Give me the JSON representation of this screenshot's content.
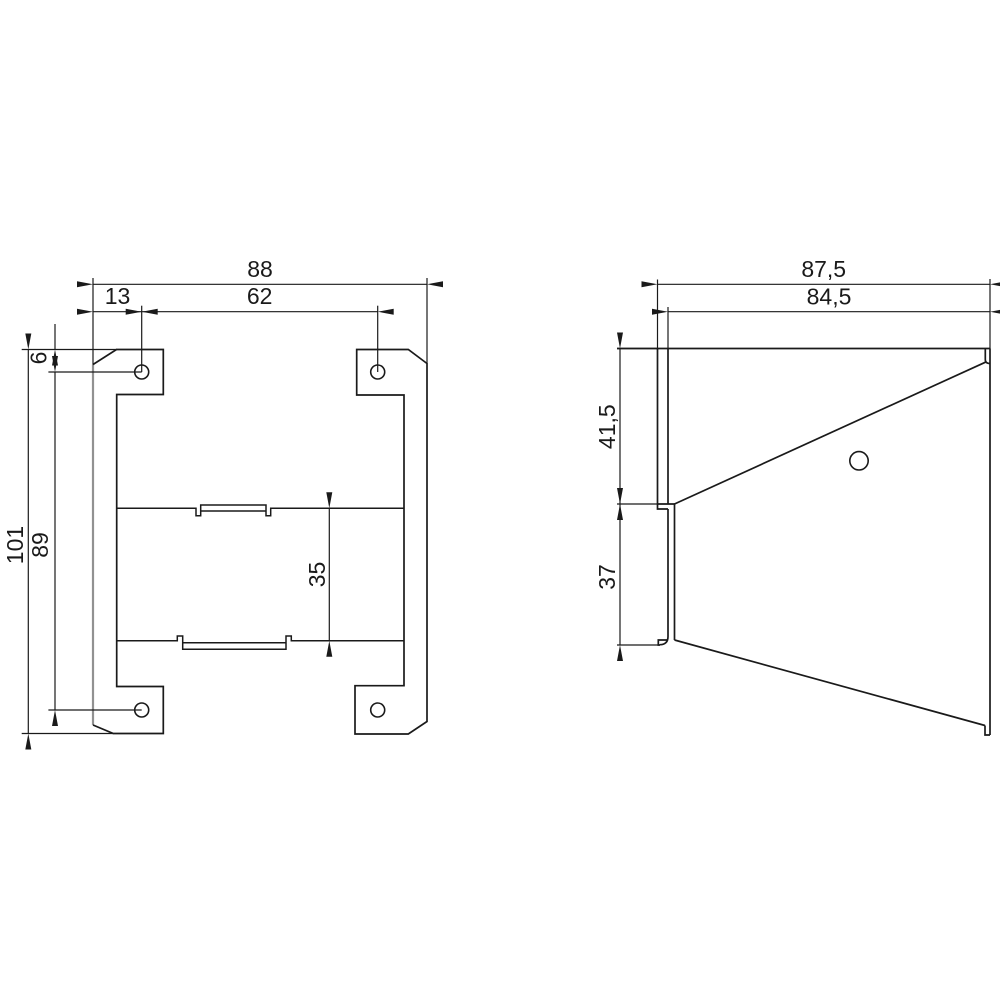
{
  "drawing": {
    "type": "technical-dimension-drawing",
    "front_view": {
      "labels": {
        "overall_width": "88",
        "hole_left_offset": "13",
        "hole_spacing_x": "62",
        "hole_top_offset": "6",
        "overall_height": "101",
        "hole_spacing_y": "89",
        "rail_section_height": "35"
      }
    },
    "side_view": {
      "labels": {
        "overall_depth": "87,5",
        "inner_depth": "84,5",
        "upper_height": "41,5",
        "lower_height": "37"
      }
    },
    "colors": {
      "line": "#1a1a1a",
      "secondary_edge": "#919191",
      "background": "#ffffff"
    }
  }
}
